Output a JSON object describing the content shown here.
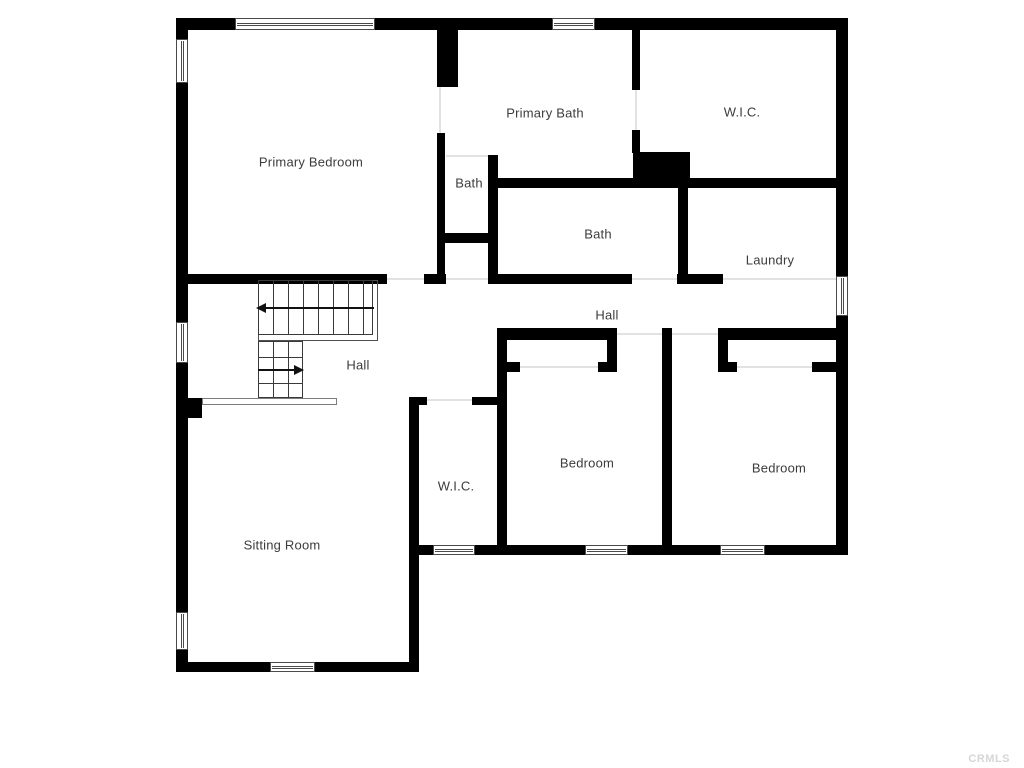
{
  "page": {
    "watermark": "CRMLS",
    "background": "#ffffff"
  },
  "colors": {
    "wall": "#000000",
    "window_frame": "#4a4a4a",
    "stair_line": "#3a3a3a",
    "door_opening": "#e2e2e2",
    "label_text": "#3c3c3c",
    "watermark_text": "#d6d6d6"
  },
  "rooms": [
    {
      "id": "primary-bedroom",
      "label": "Primary Bedroom"
    },
    {
      "id": "primary-bath",
      "label": "Primary Bath"
    },
    {
      "id": "wic-primary",
      "label": "W.I.C."
    },
    {
      "id": "bath-primary",
      "label": "Bath"
    },
    {
      "id": "bath-hall",
      "label": "Bath"
    },
    {
      "id": "laundry",
      "label": "Laundry"
    },
    {
      "id": "hall-upper",
      "label": "Hall"
    },
    {
      "id": "hall-stairs",
      "label": "Hall"
    },
    {
      "id": "wic-bedroom",
      "label": "W.I.C."
    },
    {
      "id": "bedroom-middle",
      "label": "Bedroom"
    },
    {
      "id": "bedroom-right",
      "label": "Bedroom"
    },
    {
      "id": "sitting-room",
      "label": "Sitting Room"
    }
  ]
}
